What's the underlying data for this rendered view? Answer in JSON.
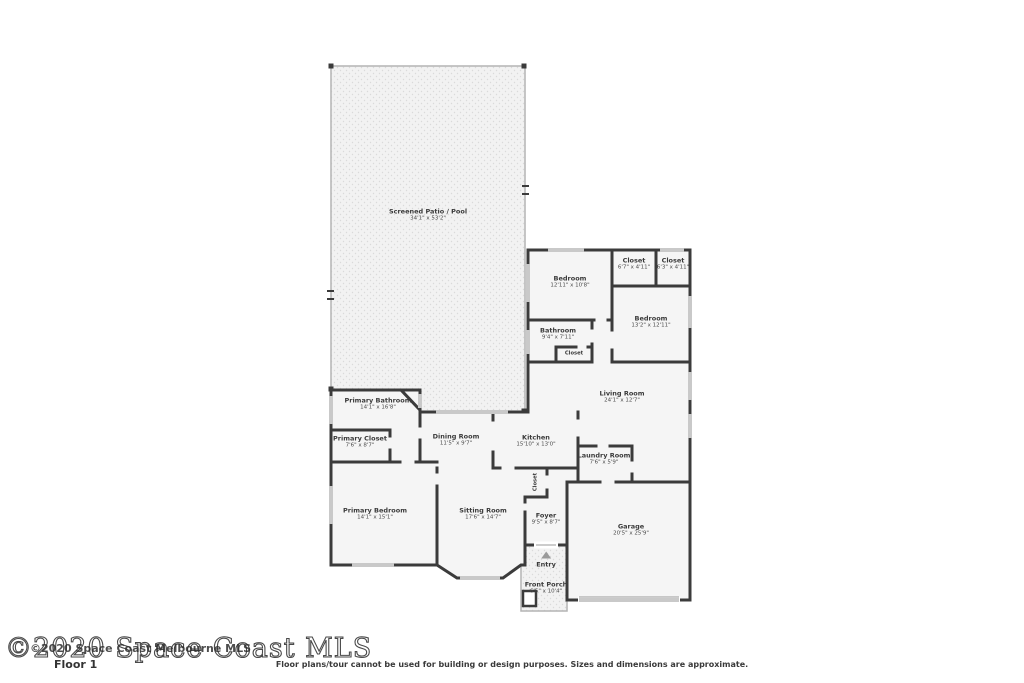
{
  "colors": {
    "wall": "#3b3b3b",
    "room_fill": "#f5f5f5",
    "patio_fill": "#f2f2f2",
    "window": "#c9c9c9",
    "label_text": "#3a3a3a"
  },
  "rooms": [
    {
      "name": "Screened Patio / Pool",
      "dims": "34'1\" x 53'2\""
    },
    {
      "name": "Bedroom",
      "dims": "12'11\" x 10'8\""
    },
    {
      "name": "Closet",
      "dims": "6'7\" x 4'11\""
    },
    {
      "name": "Closet",
      "dims": "6'3\" x 4'11\""
    },
    {
      "name": "Bedroom",
      "dims": "13'2\" x 12'11\""
    },
    {
      "name": "Bathroom",
      "dims": "9'4\" x 7'11\""
    },
    {
      "name": "Closet",
      "dims": ""
    },
    {
      "name": "Living Room",
      "dims": "24'1\" x 12'7\""
    },
    {
      "name": "Primary Bathroom",
      "dims": "14'1\" x 16'8\""
    },
    {
      "name": "Primary Closet",
      "dims": "7'6\" x 8'7\""
    },
    {
      "name": "Dining Room",
      "dims": "11'5\" x 9'7\""
    },
    {
      "name": "Kitchen",
      "dims": "15'10\" x 13'0\""
    },
    {
      "name": "Laundry Room",
      "dims": "7'6\" x 5'9\""
    },
    {
      "name": "Closet",
      "dims": ""
    },
    {
      "name": "Primary Bedroom",
      "dims": "14'1\" x 15'1\""
    },
    {
      "name": "Sitting Room",
      "dims": "17'6\" x 14'7\""
    },
    {
      "name": "Foyer",
      "dims": "9'5\" x 8'7\""
    },
    {
      "name": "Garage",
      "dims": "20'5\" x 25'9\""
    },
    {
      "name": "Entry",
      "dims": ""
    },
    {
      "name": "Front Porch",
      "dims": "6'5\" x 10'4\""
    }
  ],
  "footer": {
    "watermark_large": "©2020 Space Coast MLS",
    "watermark_small": "©2020 Space Coast Melbourne MLS",
    "floor_label": "Floor 1",
    "disclaimer": "Floor plans/tour cannot be used for building or design purposes. Sizes and dimensions are approximate."
  }
}
